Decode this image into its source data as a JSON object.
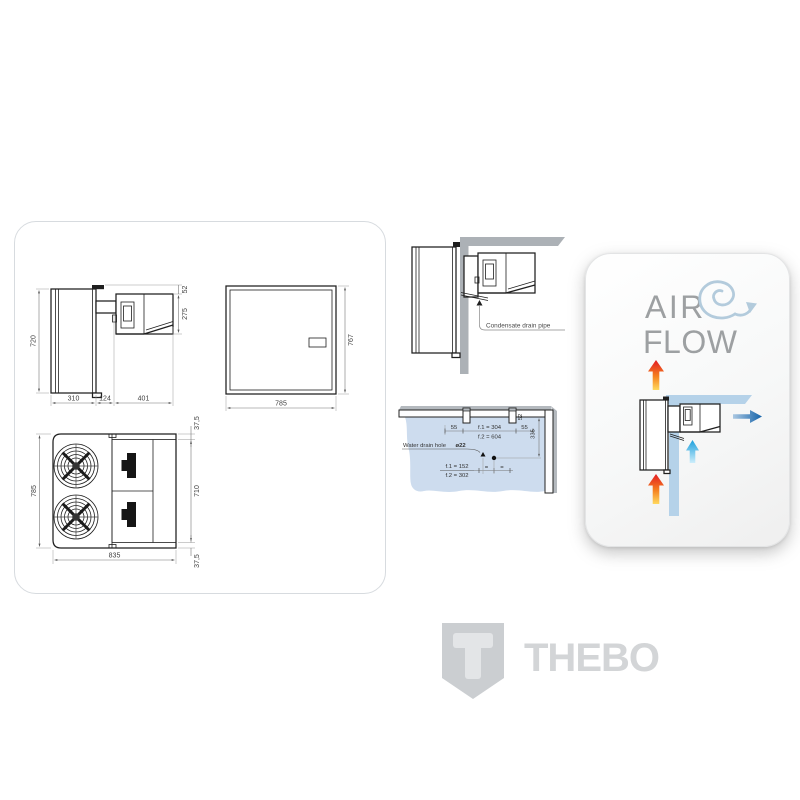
{
  "colors": {
    "panel_border": "#d7dbdf",
    "drawing_line": "#1f1f1f",
    "dimension_text": "#3f3f3f",
    "wall_gray": "#acb1b6",
    "floor_blue": "#cddcee",
    "airflow_wall_blue": "#b5d2e9",
    "hot_air_gradient": [
      "#ffd95e",
      "#f58220",
      "#e31b23"
    ],
    "cold_air_gradient": [
      "#cdeefb",
      "#1b9fdc"
    ],
    "air_out_gradient": [
      "#abc8e2",
      "#1463aa"
    ],
    "airflow_title_gray": "#9da0a2",
    "spiral_blue": "#b3cbdc",
    "brand_gray": "#d3d5d7"
  },
  "dimension_panel": {
    "side_view": {
      "height": "720",
      "top_gap": "52",
      "unit_height": "275",
      "depth_evaporator": "310",
      "wall_thickness": "124",
      "depth_condenser": "401"
    },
    "front_view": {
      "height": "767",
      "width": "785"
    },
    "plan_view": {
      "width": "785",
      "flange_top": "37,5",
      "body_depth": "710",
      "flange_bottom": "37,5",
      "length": "835"
    }
  },
  "installation": {
    "wall_section": {
      "condensate_label": "Condensate drain pipe"
    },
    "floor_plan": {
      "offset_left": "55",
      "fixing_1": "f.1 = 304",
      "fixing_2": "f.2 = 604",
      "offset_right": "55",
      "notch": "52",
      "wall_distance": "335",
      "drain_label": "Water drain hole",
      "drain_diameter": "ø22",
      "drain_1": "f.1 = 152",
      "drain_2": "f.2 = 302",
      "equal_left": "=",
      "equal_right": "="
    }
  },
  "airflow": {
    "title_line1": "AIR",
    "title_line2": "FLOW"
  },
  "brand": {
    "name": "THEBO"
  }
}
